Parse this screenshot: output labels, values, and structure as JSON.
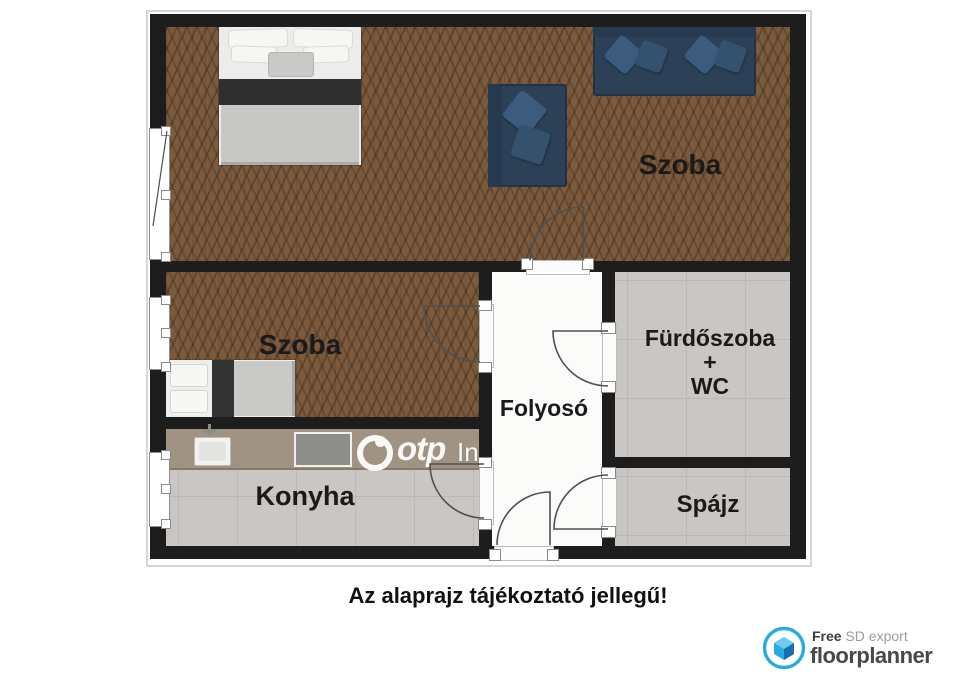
{
  "rooms": {
    "szoba_top": {
      "label": "Szoba"
    },
    "szoba_left": {
      "label": "Szoba"
    },
    "folyoso": {
      "label": "Folyosó"
    },
    "furdoszoba": {
      "lines": [
        "Fürdőszoba",
        "+",
        "WC"
      ]
    },
    "konyha": {
      "label": "Konyha"
    },
    "spajz": {
      "label": "Spájz"
    }
  },
  "disclaimer": "Az alaprajz tájékoztató jellegű!",
  "watermark": {
    "brand": "otp",
    "partial_text": "Ing"
  },
  "footer_logo": {
    "free": "Free",
    "sd_export": " SD export",
    "brand": "floorplanner"
  },
  "colors": {
    "wall": "#1d1d1d",
    "wood_floor": "#7b5a3d",
    "tile_floor": "#c9c6c3",
    "corridor_floor": "#fbfbfa",
    "kitchen_counter": "#a09383",
    "sofa_navy": "#2c4158",
    "bed_blanket_gray": "#c7c7c5",
    "logo_blue": "#29abe2"
  }
}
